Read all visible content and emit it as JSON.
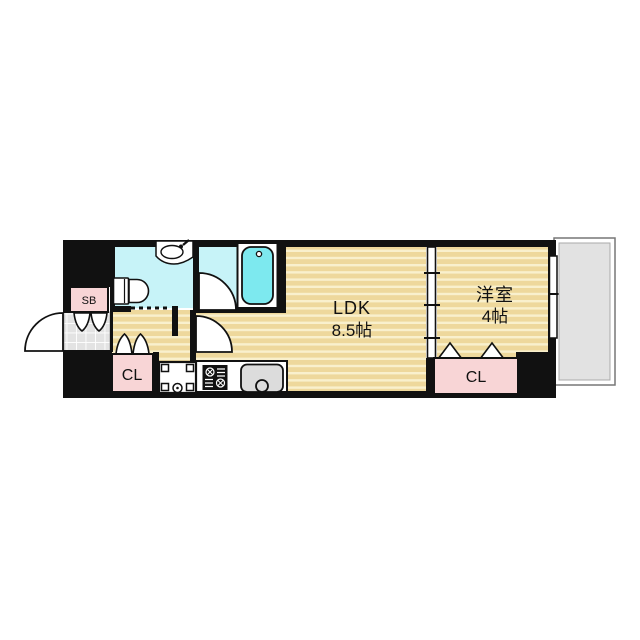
{
  "page": {
    "type": "apartment-floor-plan",
    "background": "#ffffff"
  },
  "labels": {
    "ldk_name": "LDK",
    "ldk_size": "8.5帖",
    "western_room_name": "洋室",
    "western_room_size": "4帖",
    "closet_left": "CL",
    "closet_right": "CL",
    "shoe_box": "SB"
  },
  "colors": {
    "wall": "#111111",
    "wood_base": "#eed89c",
    "wood_stripe": "#f9f0cd",
    "wet_floor": "#c7f3f8",
    "bathtub": "#7de9ef",
    "closet_pink": "#f8d5d6",
    "tile_base": "#e3e3e3",
    "tile_line": "#ffffff",
    "balcony_fill": "#e2e2e2",
    "fixture_white": "#ffffff",
    "sink_gray": "#dcdcdc",
    "stove_black": "#111111"
  },
  "fixtures": {
    "toilet": "toilet-icon",
    "washbasin": "washbasin-icon",
    "bathtub": "bathtub-icon",
    "stove": "stove-icon",
    "kitchen_sink": "kitchen-sink-icon",
    "washer_pan": "washer-pan-icon",
    "entry_door": "door-arc-icon",
    "bath_door": "door-arc-icon",
    "ldk_door": "door-arc-icon",
    "sliding_partition": "sliding-door-icon",
    "window": "window-icon",
    "toilet_sliding_track": "sliding-door-track-icon",
    "bifold_doors": "bifold-door-icon"
  }
}
